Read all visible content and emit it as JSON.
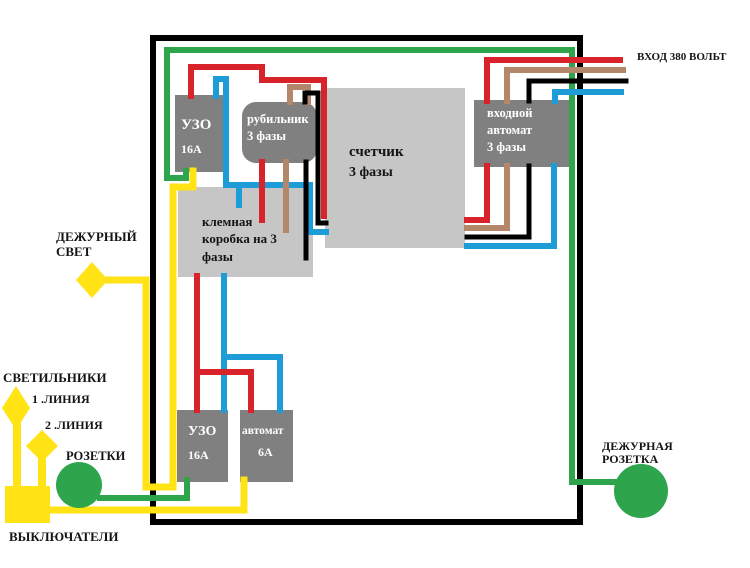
{
  "colors": {
    "red": "#D8232A",
    "green": "#2EA44D",
    "yellow": "#FFE314",
    "blue": "#1E9CD8",
    "brown": "#B4876B",
    "black": "#000000",
    "box_dark_gray": "#808080",
    "box_light_gray": "#C6C6C6"
  },
  "labels": {
    "input_voltage": "ВХОД 380 ВОЛЬТ",
    "standby_light_1": "ДЕЖУРНЫЙ",
    "standby_light_2": "СВЕТ",
    "lamps": "СВЕТИЛЬНИКИ",
    "line1": "1 .ЛИНИЯ",
    "line2": "2 .ЛИНИЯ",
    "sockets": "РОЗЕТКИ",
    "switches": "ВЫКЛЮЧАТЕЛИ",
    "standby_socket_1": "ДЕЖУРНАЯ",
    "standby_socket_2": "РОЗЕТКА"
  },
  "components": {
    "uzo_top": {
      "name": "УЗО",
      "rating": "16А"
    },
    "breaker_switch": {
      "line1": "рубильник",
      "line2": "3 фазы"
    },
    "meter": {
      "line1": "счетчик",
      "line2": "3 фазы"
    },
    "input_breaker": {
      "line1": "входной",
      "line2": "автомат",
      "line3": "3 фазы"
    },
    "terminal_box": {
      "line1": "клемная",
      "line2": "коробка на 3",
      "line3": "фазы"
    },
    "uzo_bottom": {
      "name": "УЗО",
      "rating": "16А"
    },
    "avtomat_6a": {
      "name": "автомат",
      "rating": "6А"
    }
  }
}
